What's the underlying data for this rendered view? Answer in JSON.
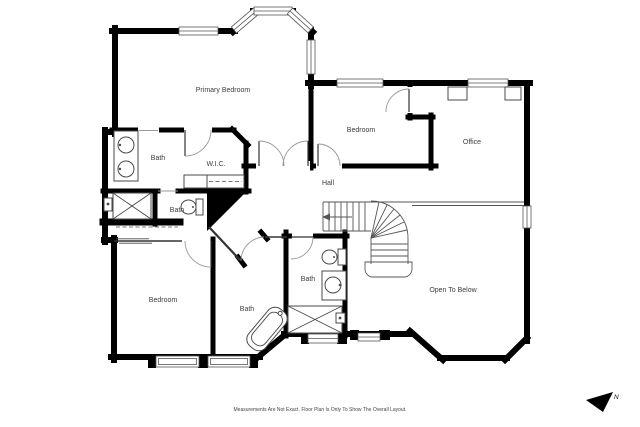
{
  "rooms": {
    "primary_bedroom": "Primary Bedroom",
    "bedroom_top": "Bedroom",
    "office": "Office",
    "bath_primary": "Bath",
    "wic": "W.I.C.",
    "hall": "Hall",
    "bath_left": "Bath",
    "bedroom_bottom": "Bedroom",
    "bath_bottom": "Bath",
    "bath_middle": "Bath",
    "open_to_below": "Open To Below"
  },
  "footer": {
    "disclaimer": "Measurements Are Not Exact. Floor Plan Is Only To Show The Overall Layout."
  },
  "compass": {
    "label": "N"
  },
  "colors": {
    "wall": "#000000",
    "fixture": "#4a4a4a",
    "label_text": "#3d3d3d",
    "background": "#ffffff"
  }
}
